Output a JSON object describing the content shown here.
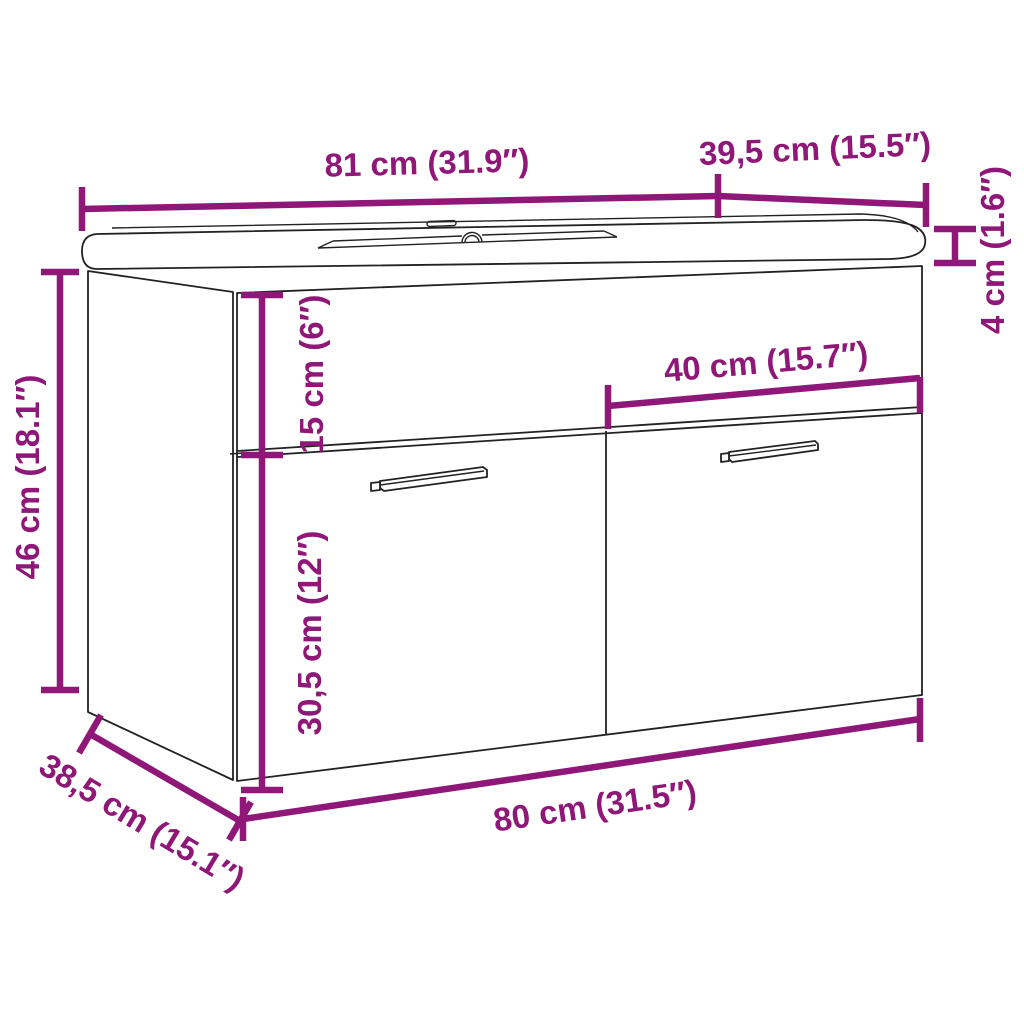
{
  "diagram": {
    "type": "product-dimension-drawing",
    "subject": "wall-mounted bathroom vanity cabinet with built-in basin, two doors with handles",
    "background_color": "#ffffff",
    "annotation_color": "#8E1777",
    "line_art_color": "#222222"
  },
  "dimensions": {
    "top_width": {
      "label": "81 cm (31.9″)",
      "value_cm": 81,
      "value_in": 31.9,
      "where": "basin top width, upper edge"
    },
    "top_depth": {
      "label": "39,5 cm (15.5″)",
      "value_cm": 39.5,
      "value_in": 15.5,
      "where": "basin top depth, upper right"
    },
    "basin_thickness": {
      "label": "4 cm (1.6″)",
      "value_cm": 4,
      "value_in": 1.6,
      "where": "basin slab thickness, right side"
    },
    "cabinet_height": {
      "label": "46 cm (18.1″)",
      "value_cm": 46,
      "value_in": 18.1,
      "where": "cabinet height, left side"
    },
    "apron_height": {
      "label": "15 cm (6″)",
      "value_cm": 15,
      "value_in": 6,
      "where": "upper front panel height"
    },
    "door_height": {
      "label": "30,5 cm (12″)",
      "value_cm": 30.5,
      "value_in": 12,
      "where": "door height, lower front"
    },
    "door_width": {
      "label": "40 cm (15.7″)",
      "value_cm": 40,
      "value_in": 15.7,
      "where": "right door width"
    },
    "cabinet_width": {
      "label": "80 cm (31.5″)",
      "value_cm": 80,
      "value_in": 31.5,
      "where": "cabinet width, bottom front edge"
    },
    "cabinet_depth": {
      "label": "38,5 cm (15.1″)",
      "value_cm": 38.5,
      "value_in": 15.1,
      "where": "cabinet depth, bottom left diagonal"
    }
  }
}
